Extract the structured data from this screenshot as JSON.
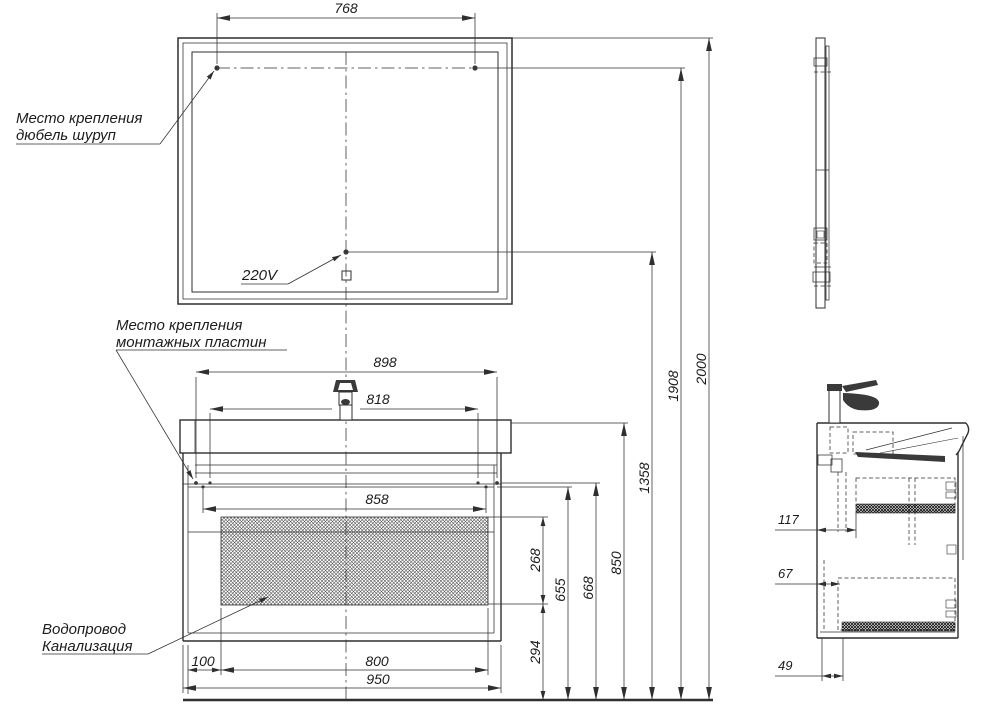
{
  "labels": {
    "mount_dowel_1": "Место крепления",
    "mount_dowel_2": "дюбель шуруп",
    "power_socket": "220V",
    "mount_plates_1": "Место крепления",
    "mount_plates_2": "монтажных пластин",
    "plumbing_1": "Водопровод",
    "plumbing_2": "Канализация"
  },
  "dims": {
    "mirror_holes_span": "768",
    "plates_outer_span": "898",
    "plates_inner_span": "818",
    "cabinet_opening_span": "858",
    "service_zone_height": "268",
    "bottom_clearance": "294",
    "drawer_top_height": "655",
    "plates_height": "668",
    "countertop_height": "850",
    "socket_height": "1358",
    "holes_height": "1908",
    "overall_height": "2000",
    "side_offset": "100",
    "service_zone_span": "800",
    "cabinet_span": "950",
    "pipe_offset_top": "117",
    "pipe_offset_mid": "67",
    "pipe_offset_bottom": "49"
  },
  "colors": {
    "line": "#2f2f2f",
    "text": "#1c1c1c",
    "dark_fill": "#3a3a3a",
    "background": "#ffffff"
  }
}
